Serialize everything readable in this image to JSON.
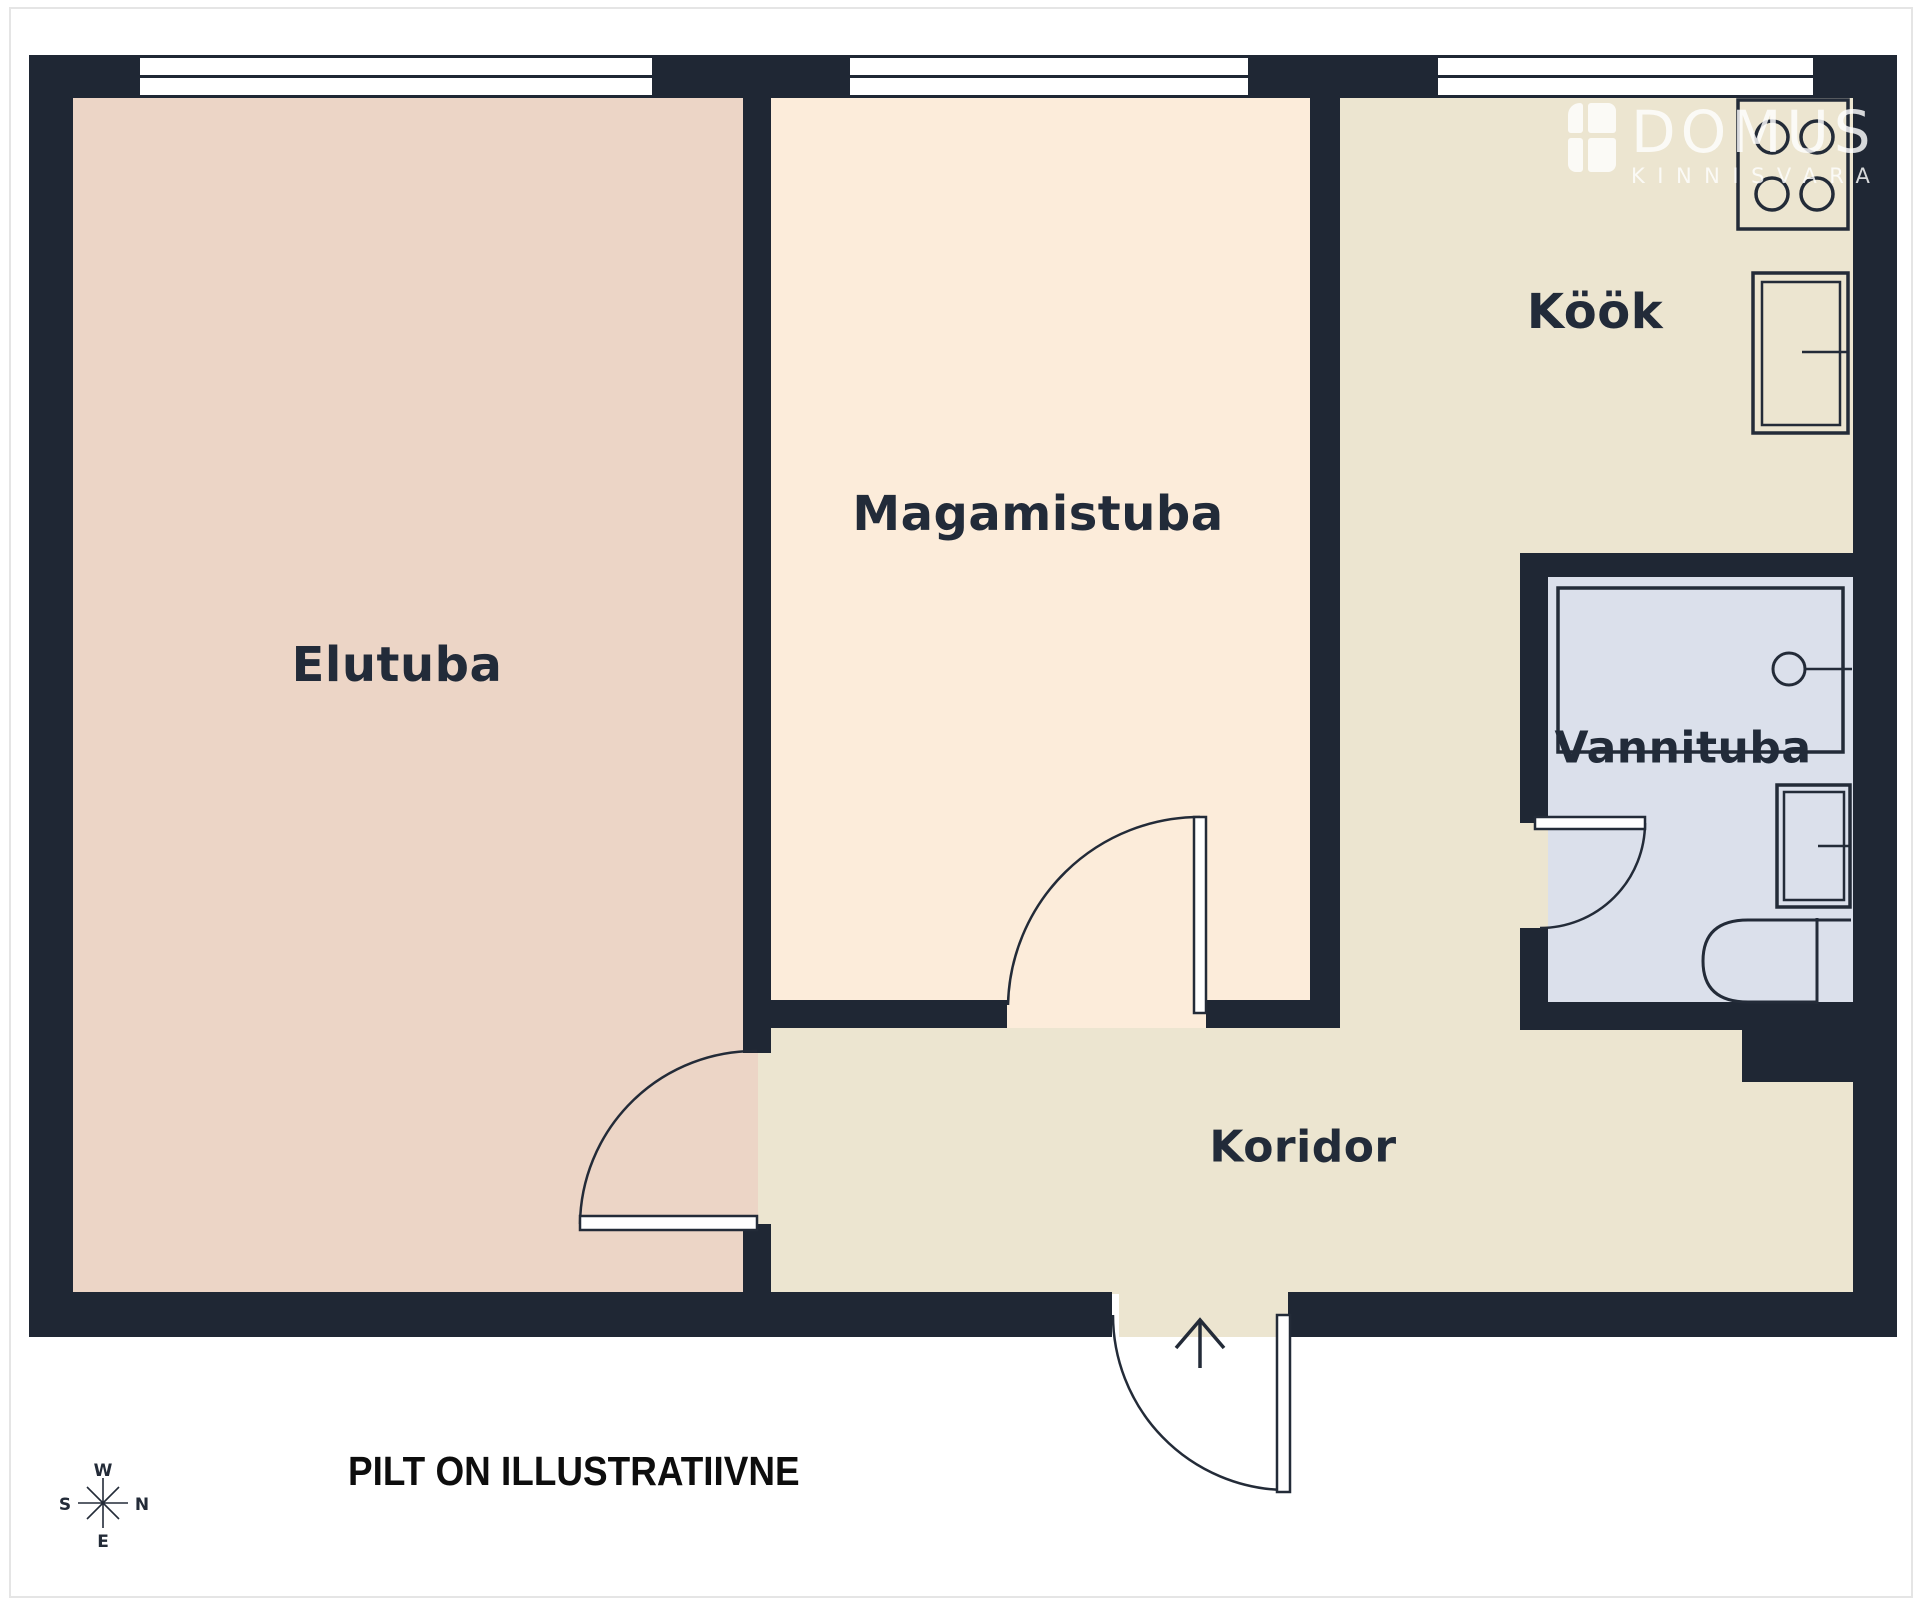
{
  "rooms": [
    {
      "id": "elutuba",
      "label": "Elutuba"
    },
    {
      "id": "magamistuba",
      "label": "Magamistuba"
    },
    {
      "id": "kook",
      "label": "Köök"
    },
    {
      "id": "vannituba",
      "label": "Vannituba"
    },
    {
      "id": "koridor",
      "label": "Koridor"
    }
  ],
  "logo": {
    "brand": "DOMUS",
    "subtitle": "KINNISVARA",
    "icon": "window-icon"
  },
  "compass": {
    "top": "W",
    "right": "N",
    "left": "S",
    "bottom": "E"
  },
  "disclaimer": "PILT ON ILLUSTRATIIVNE",
  "fixtures": [
    "stove",
    "kitchen-counter",
    "bathtub",
    "sink-faucet",
    "washing-machine",
    "toilet"
  ],
  "doors": [
    "entrance-door",
    "living-room-door",
    "bedroom-door",
    "bathroom-door"
  ],
  "windows_count": 3,
  "colors": {
    "wall": "#1f2734",
    "line": "#232b38",
    "living_room_floor": "#ecd5c6",
    "bedroom_floor": "#fcecda",
    "kitchen_corridor_floor": "#ece5d0",
    "bathroom_floor": "#dbe0eb",
    "background": "#ffffff",
    "frame_border": "#e5e5e5",
    "label_text": "#222b39",
    "disclaimer_text": "#0d0d0d",
    "logo_white": "#ffffff"
  }
}
